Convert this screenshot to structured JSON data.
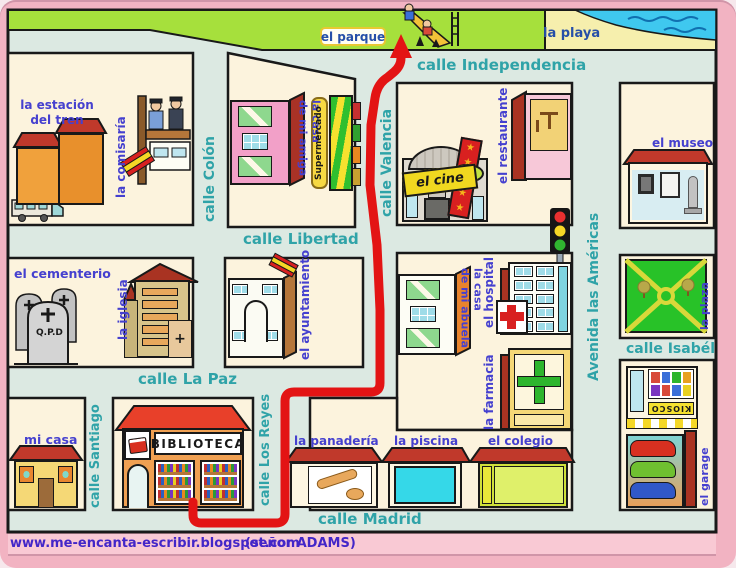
{
  "areas": {
    "park": "el parque",
    "beach": "la playa"
  },
  "streets": {
    "independencia": "calle Independencia",
    "colon": "calle Colón",
    "valencia": "calle Valencia",
    "libertad": "calle Libertad",
    "americas": "Avenida las Américas",
    "la_paz": "calle La Paz",
    "isabel": "calle Isabél",
    "santiago": "calle Santiago",
    "los_reyes": "calle Los Reyes",
    "madrid": "calle Madrid"
  },
  "places": {
    "estacion_1": "la estación",
    "estacion_2": "del tren",
    "comisaria": "la comisaría",
    "amiga_1": "la casa",
    "amiga_2": "de mi amiga",
    "supermercado": "Supermercado",
    "cine": "el cine",
    "restaurante": "el restaurante",
    "museo": "el museo",
    "cementerio": "el cementerio",
    "qpd": "Q.P.D",
    "iglesia": "la iglesia",
    "ayuntamiento": "el ayuntamiento",
    "abuela_1": "la casa",
    "abuela_2": "de mi abuela",
    "hospital": "el hospital",
    "farmacia": "la farmacia",
    "plaza": "la plaza",
    "kiosco": "KIOSCO",
    "garage": "el garage",
    "mi_casa": "mi casa",
    "biblioteca": "BIBLIOTECA",
    "panaderia": "la panadería",
    "piscina": "la piscina",
    "colegio": "el colegio"
  },
  "footer": {
    "url": "www.me-encanta-escribir.blogspot.com",
    "credit": "(señor ADAMS)"
  },
  "colors": {
    "frame_pink": "#f2b3c2",
    "street": "#dce9e2",
    "block_cream": "#fcf3dd",
    "street_label": "#2fa3a8",
    "place_label": "#4540cf",
    "park_green": "#a6e03c",
    "sand": "#f6efad",
    "water": "#3fc8ef",
    "route_red": "#e31414",
    "roof_red": "#c0392b"
  }
}
